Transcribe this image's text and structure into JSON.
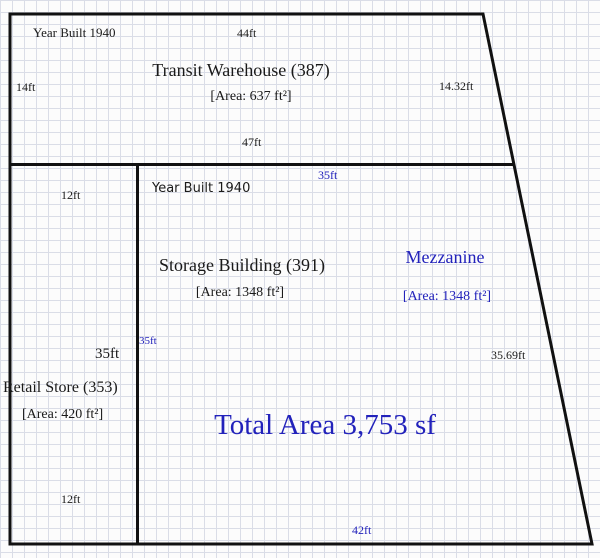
{
  "diagram": {
    "type": "property-sketch",
    "colors": {
      "outline": "#111111",
      "black_text": "#1a1a1a",
      "blue_text": "#2222bb",
      "grid_line": "#dadde7",
      "background": "#fcfcfc"
    },
    "sections": {
      "warehouse": {
        "year_built": "Year Built 1940",
        "name": "Transit Warehouse (387)",
        "area": "[Area: 637 ft²]",
        "dim_top": "44ft",
        "dim_left": "14ft",
        "dim_right": "14.32ft",
        "dim_bottom": "47ft"
      },
      "storage": {
        "year_built": "Year Built 1940",
        "name": "Storage Building (391)",
        "area": "[Area: 1348 ft²]",
        "dim_left_blue": "35ft",
        "dim_left_black": "35ft"
      },
      "mezzanine": {
        "name": "Mezzanine",
        "area": "[Area: 1348 ft²]",
        "dim_top": "35ft",
        "dim_right": "35.69ft",
        "dim_bottom": "42ft"
      },
      "retail": {
        "name": "Retail Store (353)",
        "area": "[Area: 420 ft²]",
        "dim_top": "12ft",
        "dim_bottom": "12ft"
      }
    },
    "total_area": "Total Area 3,753 sf"
  }
}
